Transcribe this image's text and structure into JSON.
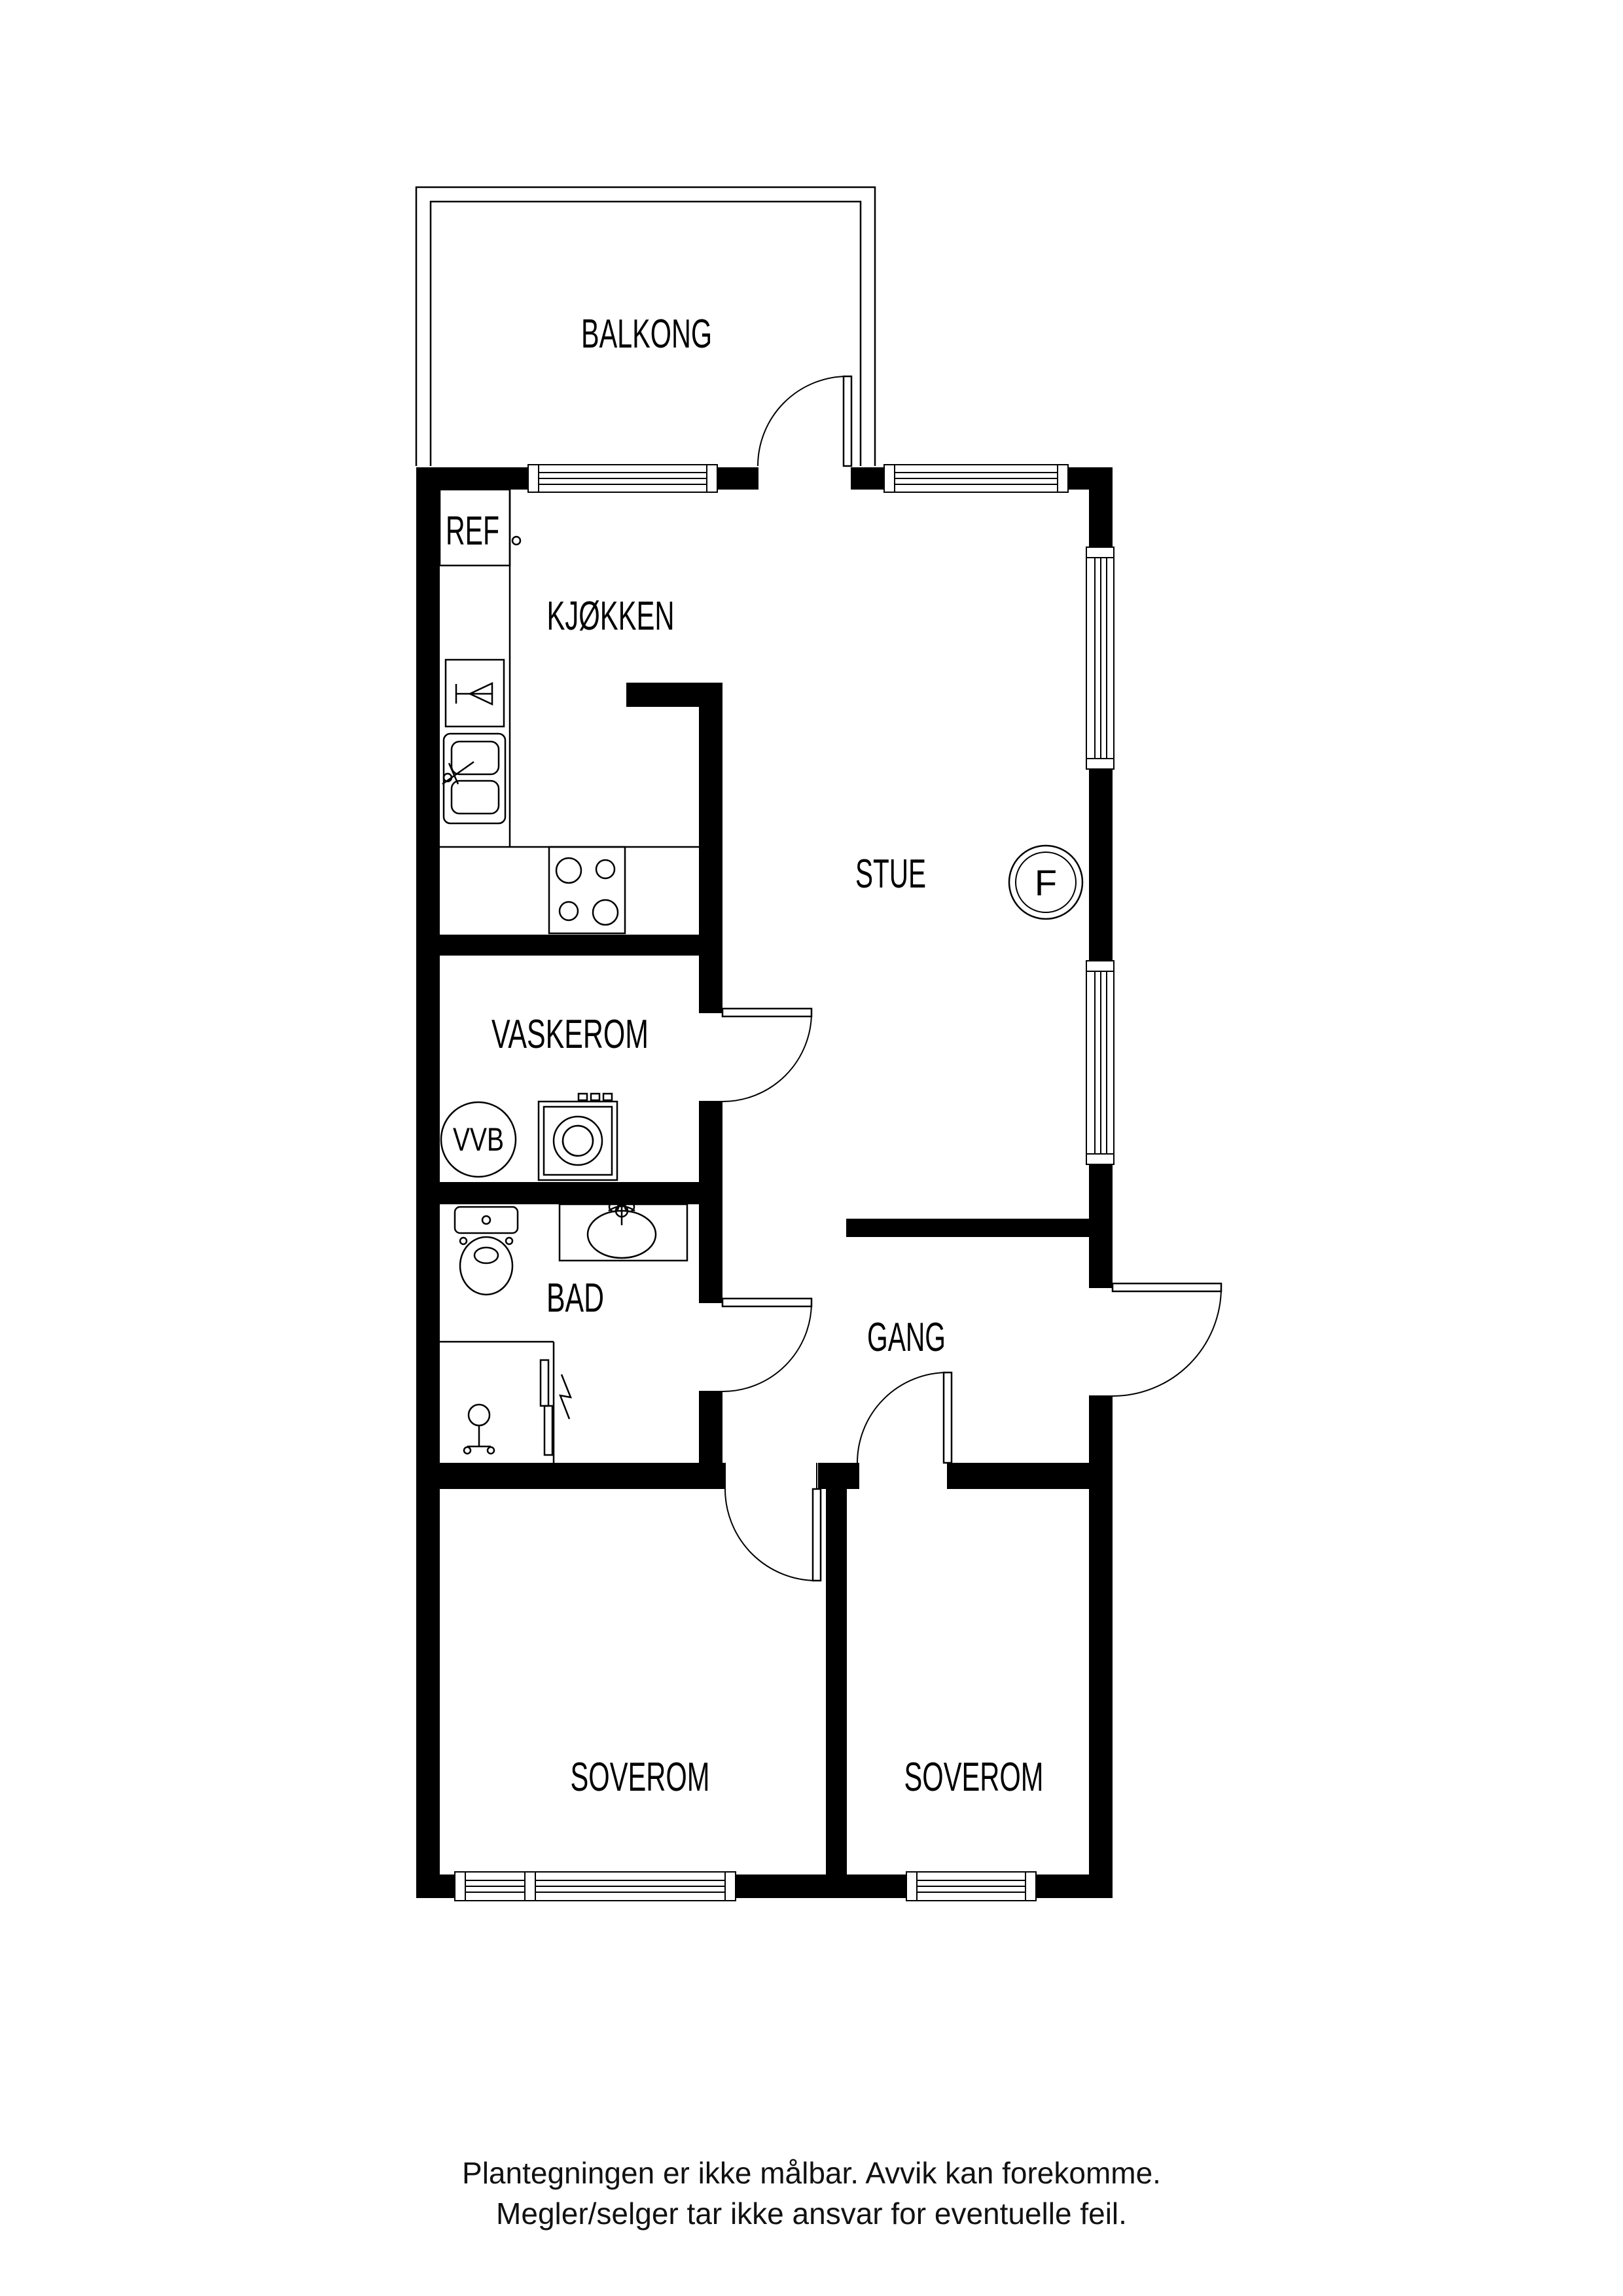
{
  "colors": {
    "background": "#ffffff",
    "walls": "#000000",
    "lines": "#000000",
    "text": "#000000"
  },
  "floor_plan": {
    "labels": {
      "balcony": "BALKONG",
      "kitchen": "KJØKKEN",
      "fridge": "REF",
      "living_room": "STUE",
      "fireplace": "F",
      "laundry": "VASKEROM",
      "water_heater": "VVB",
      "bathroom": "BAD",
      "hallway": "GANG",
      "bedroom_left": "SOVEROM",
      "bedroom_right": "SOVEROM"
    },
    "disclaimer": {
      "line1": "Plantegningen er ikke målbar. Avvik kan forekomme.",
      "line2": "Megler/selger tar ikke ansvar for eventuelle feil."
    }
  }
}
